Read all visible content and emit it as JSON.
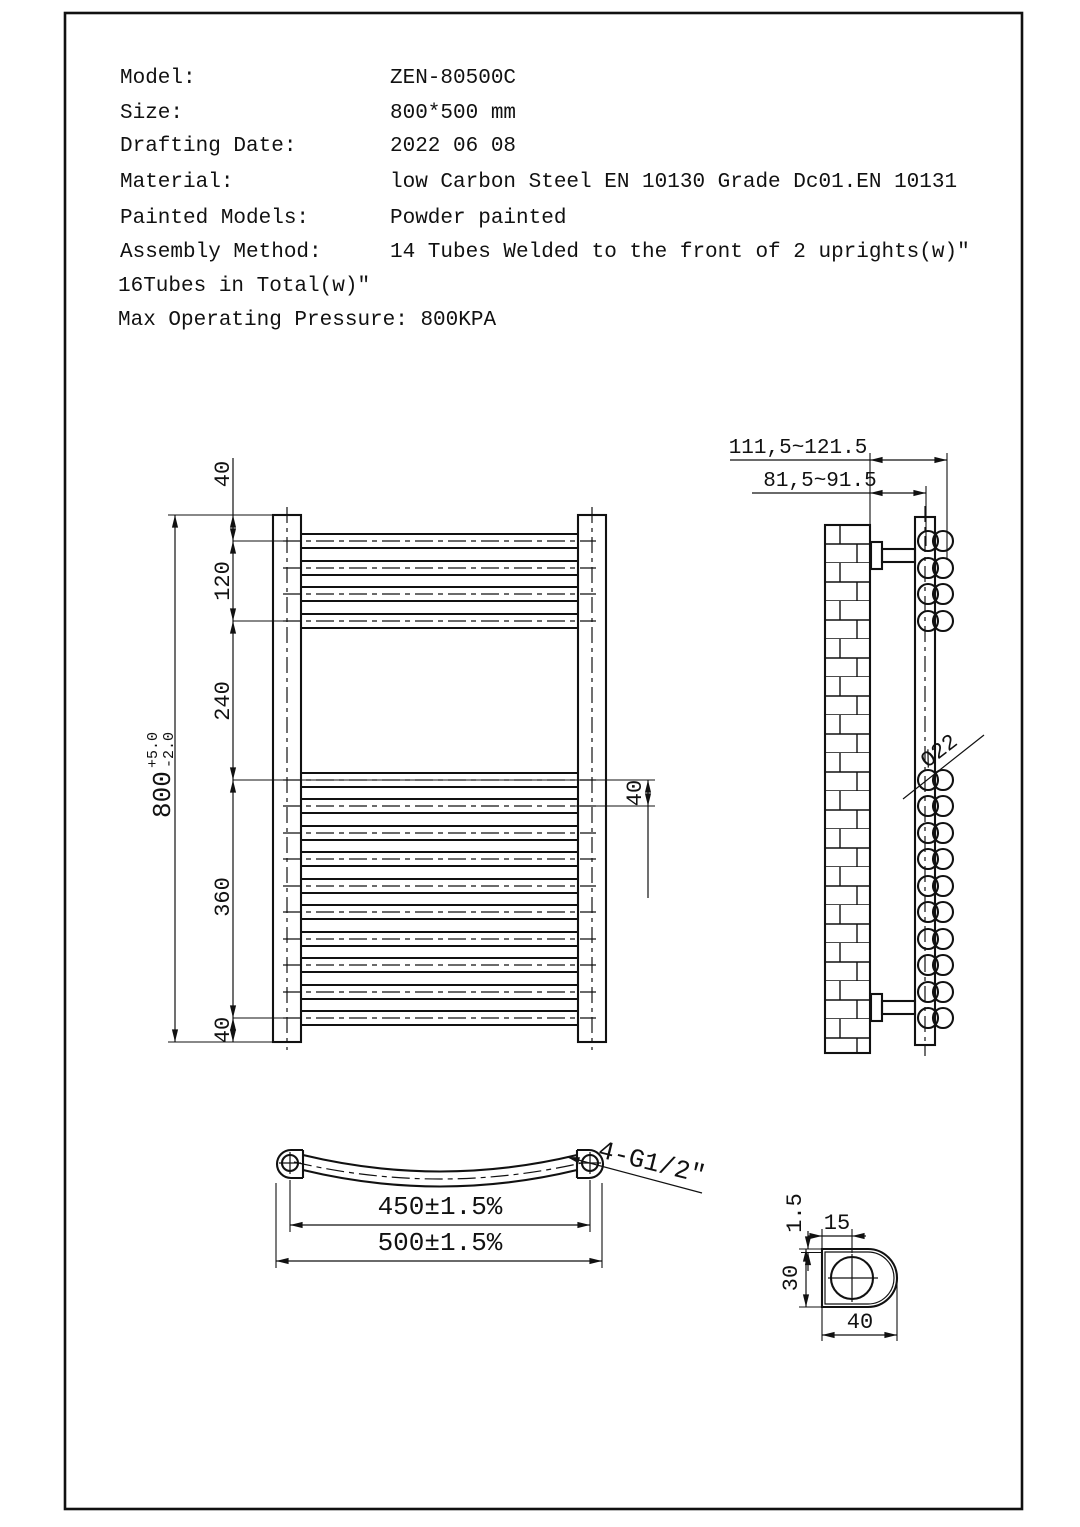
{
  "header": {
    "rows": [
      {
        "label": "Model:",
        "value": "ZEN-80500C"
      },
      {
        "label": "Size:",
        "value": "800*500 mm"
      },
      {
        "label": "Drafting Date:",
        "value": "2022 06 08"
      },
      {
        "label": "Material:",
        "value": "low Carbon Steel  EN 10130 Grade Dc01.EN 10131"
      },
      {
        "label": "Painted Models:",
        "value": "Powder painted"
      },
      {
        "label": "Assembly Method:",
        "value": "14 Tubes Welded to the front of 2 uprights(w)\""
      }
    ],
    "assembly_continuation": "16Tubes in Total(w)\"",
    "max_pressure": "Max Operating Pressure: 800KPA"
  },
  "front_view": {
    "dim_top": "40",
    "dim_group1": "120",
    "dim_gap": "240",
    "dim_group2": "360",
    "dim_bottom": "40",
    "dim_overall": "800",
    "tol_plus": "+5.0",
    "tol_minus": "-2.0",
    "dim_tube_pitch": "40"
  },
  "side_view": {
    "dim_wall_to_front": "111,5~121.5",
    "dim_wall_to_center": "81,5~91.5",
    "tube_diameter": "Ø22"
  },
  "top_view": {
    "dim_bracket_centers": "450±1.5%",
    "dim_overall_width": "500±1.5%",
    "thread_label": "4-G1/2\""
  },
  "detail_view": {
    "dim_thickness": "1.5",
    "dim_hole_offset": "15",
    "dim_depth": "30",
    "dim_width": "40"
  },
  "colors": {
    "line": "#111111",
    "background": "#ffffff"
  }
}
